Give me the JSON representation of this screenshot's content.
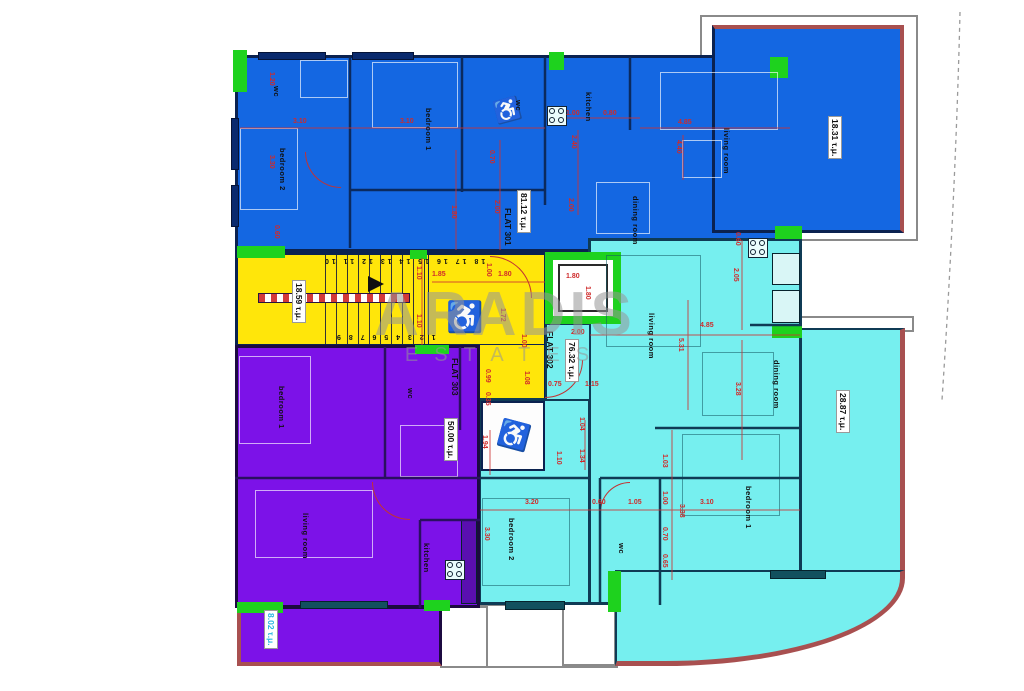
{
  "watermark": {
    "line1": "ARADIS",
    "line2": "ESTATES"
  },
  "flats": [
    {
      "id": "flat-301",
      "label": "FLAT 301",
      "area": "81.12 τ.μ.",
      "fill": "#1467e2"
    },
    {
      "id": "flat-302",
      "label": "FLAT 302",
      "area": "76.32 τ.μ.",
      "fill": "#76efef"
    },
    {
      "id": "flat-303",
      "label": "FLAT 303",
      "area": "50.00 τ.μ.",
      "fill": "#7c12e8"
    }
  ],
  "balconies": [
    {
      "area": "18.31 τ.μ."
    },
    {
      "area": "28.87 τ.μ."
    },
    {
      "area": "8.02 τ.μ."
    }
  ],
  "common": {
    "stairwell_area": "18.59 τ.μ.",
    "stair_numbers_top": "18 17 16 15 14 13 12 11 10",
    "stair_numbers_bottom": "1 2 3 4 5 6 7 8 9"
  },
  "area_labels": [
    {
      "t": "81.12 τ.μ.",
      "x": 517,
      "y": 190,
      "v": true,
      "box": true
    },
    {
      "t": "FLAT 301",
      "x": 503,
      "y": 208,
      "v": true
    },
    {
      "t": "18.31 τ.μ.",
      "x": 828,
      "y": 116,
      "v": true,
      "box": true
    },
    {
      "t": "18.59 τ.μ.",
      "x": 292,
      "y": 280,
      "v": true,
      "box": true
    },
    {
      "t": "FLAT 302",
      "x": 545,
      "y": 331,
      "v": true
    },
    {
      "t": "76.32 τ.μ.",
      "x": 565,
      "y": 339,
      "v": true,
      "box": true
    },
    {
      "t": "28.87 τ.μ.",
      "x": 836,
      "y": 390,
      "v": true,
      "box": true
    },
    {
      "t": "FLAT 303",
      "x": 450,
      "y": 358,
      "v": true
    },
    {
      "t": "50.00 τ.μ.",
      "x": 444,
      "y": 418,
      "v": true,
      "box": true
    },
    {
      "t": "8.02 τ.μ.",
      "x": 264,
      "y": 610,
      "v": true,
      "box": true,
      "color": "#2bb7e0"
    }
  ],
  "room_labels": [
    {
      "t": "wc",
      "x": 272,
      "y": 86,
      "v": true
    },
    {
      "t": "bedroom 2",
      "x": 278,
      "y": 148,
      "v": true
    },
    {
      "t": "bedroom 1",
      "x": 424,
      "y": 108,
      "v": true
    },
    {
      "t": "wc",
      "x": 514,
      "y": 100,
      "v": true
    },
    {
      "t": "kitchen",
      "x": 584,
      "y": 92,
      "v": true
    },
    {
      "t": "living room",
      "x": 722,
      "y": 128,
      "v": true
    },
    {
      "t": "dining room",
      "x": 631,
      "y": 196,
      "v": true
    },
    {
      "t": "living room",
      "x": 647,
      "y": 313,
      "v": true
    },
    {
      "t": "dining room",
      "x": 772,
      "y": 360,
      "v": true
    },
    {
      "t": "bedroom 2",
      "x": 507,
      "y": 518,
      "v": true
    },
    {
      "t": "wc",
      "x": 617,
      "y": 543,
      "v": true
    },
    {
      "t": "bedroom 1",
      "x": 744,
      "y": 486,
      "v": true
    },
    {
      "t": "bedroom 1",
      "x": 277,
      "y": 386,
      "v": true
    },
    {
      "t": "wc",
      "x": 406,
      "y": 388,
      "v": true
    },
    {
      "t": "living room",
      "x": 301,
      "y": 513,
      "v": true
    },
    {
      "t": "kitchen",
      "x": 422,
      "y": 543,
      "v": true
    }
  ],
  "dimensions": [
    {
      "t": "3.10",
      "x": 293,
      "y": 118
    },
    {
      "t": "3.10",
      "x": 400,
      "y": 118
    },
    {
      "t": "1.00",
      "x": 566,
      "y": 110
    },
    {
      "t": "0.80",
      "x": 603,
      "y": 110
    },
    {
      "t": "4.85",
      "x": 678,
      "y": 119
    },
    {
      "t": "1.85",
      "x": 432,
      "y": 271
    },
    {
      "t": "1.80",
      "x": 498,
      "y": 271
    },
    {
      "t": "1.80",
      "x": 566,
      "y": 273
    },
    {
      "t": "2.00",
      "x": 571,
      "y": 329
    },
    {
      "t": "4.85",
      "x": 700,
      "y": 322
    },
    {
      "t": "0.75",
      "x": 548,
      "y": 381
    },
    {
      "t": "1.15",
      "x": 585,
      "y": 381
    },
    {
      "t": "3.20",
      "x": 525,
      "y": 499
    },
    {
      "t": "0.60",
      "x": 592,
      "y": 499
    },
    {
      "t": "1.05",
      "x": 628,
      "y": 499
    },
    {
      "t": "3.10",
      "x": 700,
      "y": 499
    },
    {
      "t": "1.20",
      "x": 268,
      "y": 72,
      "v": true
    },
    {
      "t": "3.30",
      "x": 268,
      "y": 155,
      "v": true
    },
    {
      "t": "0.60",
      "x": 273,
      "y": 225,
      "v": true
    },
    {
      "t": "0.70",
      "x": 488,
      "y": 150,
      "v": true
    },
    {
      "t": "2.00",
      "x": 493,
      "y": 200,
      "v": true
    },
    {
      "t": "1.80",
      "x": 450,
      "y": 205,
      "v": true
    },
    {
      "t": "2.40",
      "x": 570,
      "y": 135,
      "v": true
    },
    {
      "t": "2.00",
      "x": 567,
      "y": 198,
      "v": true
    },
    {
      "t": "4.40",
      "x": 675,
      "y": 140,
      "v": true
    },
    {
      "t": "0.60",
      "x": 734,
      "y": 232,
      "v": true
    },
    {
      "t": "2.05",
      "x": 732,
      "y": 268,
      "v": true
    },
    {
      "t": "5.31",
      "x": 677,
      "y": 338,
      "v": true
    },
    {
      "t": "3.28",
      "x": 734,
      "y": 382,
      "v": true
    },
    {
      "t": "1.10",
      "x": 415,
      "y": 266,
      "v": true
    },
    {
      "t": "1.10",
      "x": 415,
      "y": 314,
      "v": true
    },
    {
      "t": "1.00",
      "x": 485,
      "y": 263,
      "v": true
    },
    {
      "t": "1.72",
      "x": 499,
      "y": 308,
      "v": true
    },
    {
      "t": "1.80",
      "x": 584,
      "y": 286,
      "v": true
    },
    {
      "t": "1.00",
      "x": 520,
      "y": 334,
      "v": true
    },
    {
      "t": "1.08",
      "x": 523,
      "y": 371,
      "v": true
    },
    {
      "t": "0.99",
      "x": 484,
      "y": 369,
      "v": true
    },
    {
      "t": "0.35",
      "x": 484,
      "y": 392,
      "v": true
    },
    {
      "t": "1.04",
      "x": 578,
      "y": 417,
      "v": true
    },
    {
      "t": "1.94",
      "x": 481,
      "y": 435,
      "v": true
    },
    {
      "t": "1.10",
      "x": 555,
      "y": 451,
      "v": true
    },
    {
      "t": "1.34",
      "x": 578,
      "y": 449,
      "v": true
    },
    {
      "t": "1.03",
      "x": 661,
      "y": 454,
      "v": true
    },
    {
      "t": "1.00",
      "x": 661,
      "y": 491,
      "v": true
    },
    {
      "t": "0.70",
      "x": 661,
      "y": 527,
      "v": true
    },
    {
      "t": "0.65",
      "x": 661,
      "y": 554,
      "v": true
    },
    {
      "t": "3.38",
      "x": 678,
      "y": 504,
      "v": true
    },
    {
      "t": "3.30",
      "x": 483,
      "y": 527,
      "v": true
    }
  ]
}
